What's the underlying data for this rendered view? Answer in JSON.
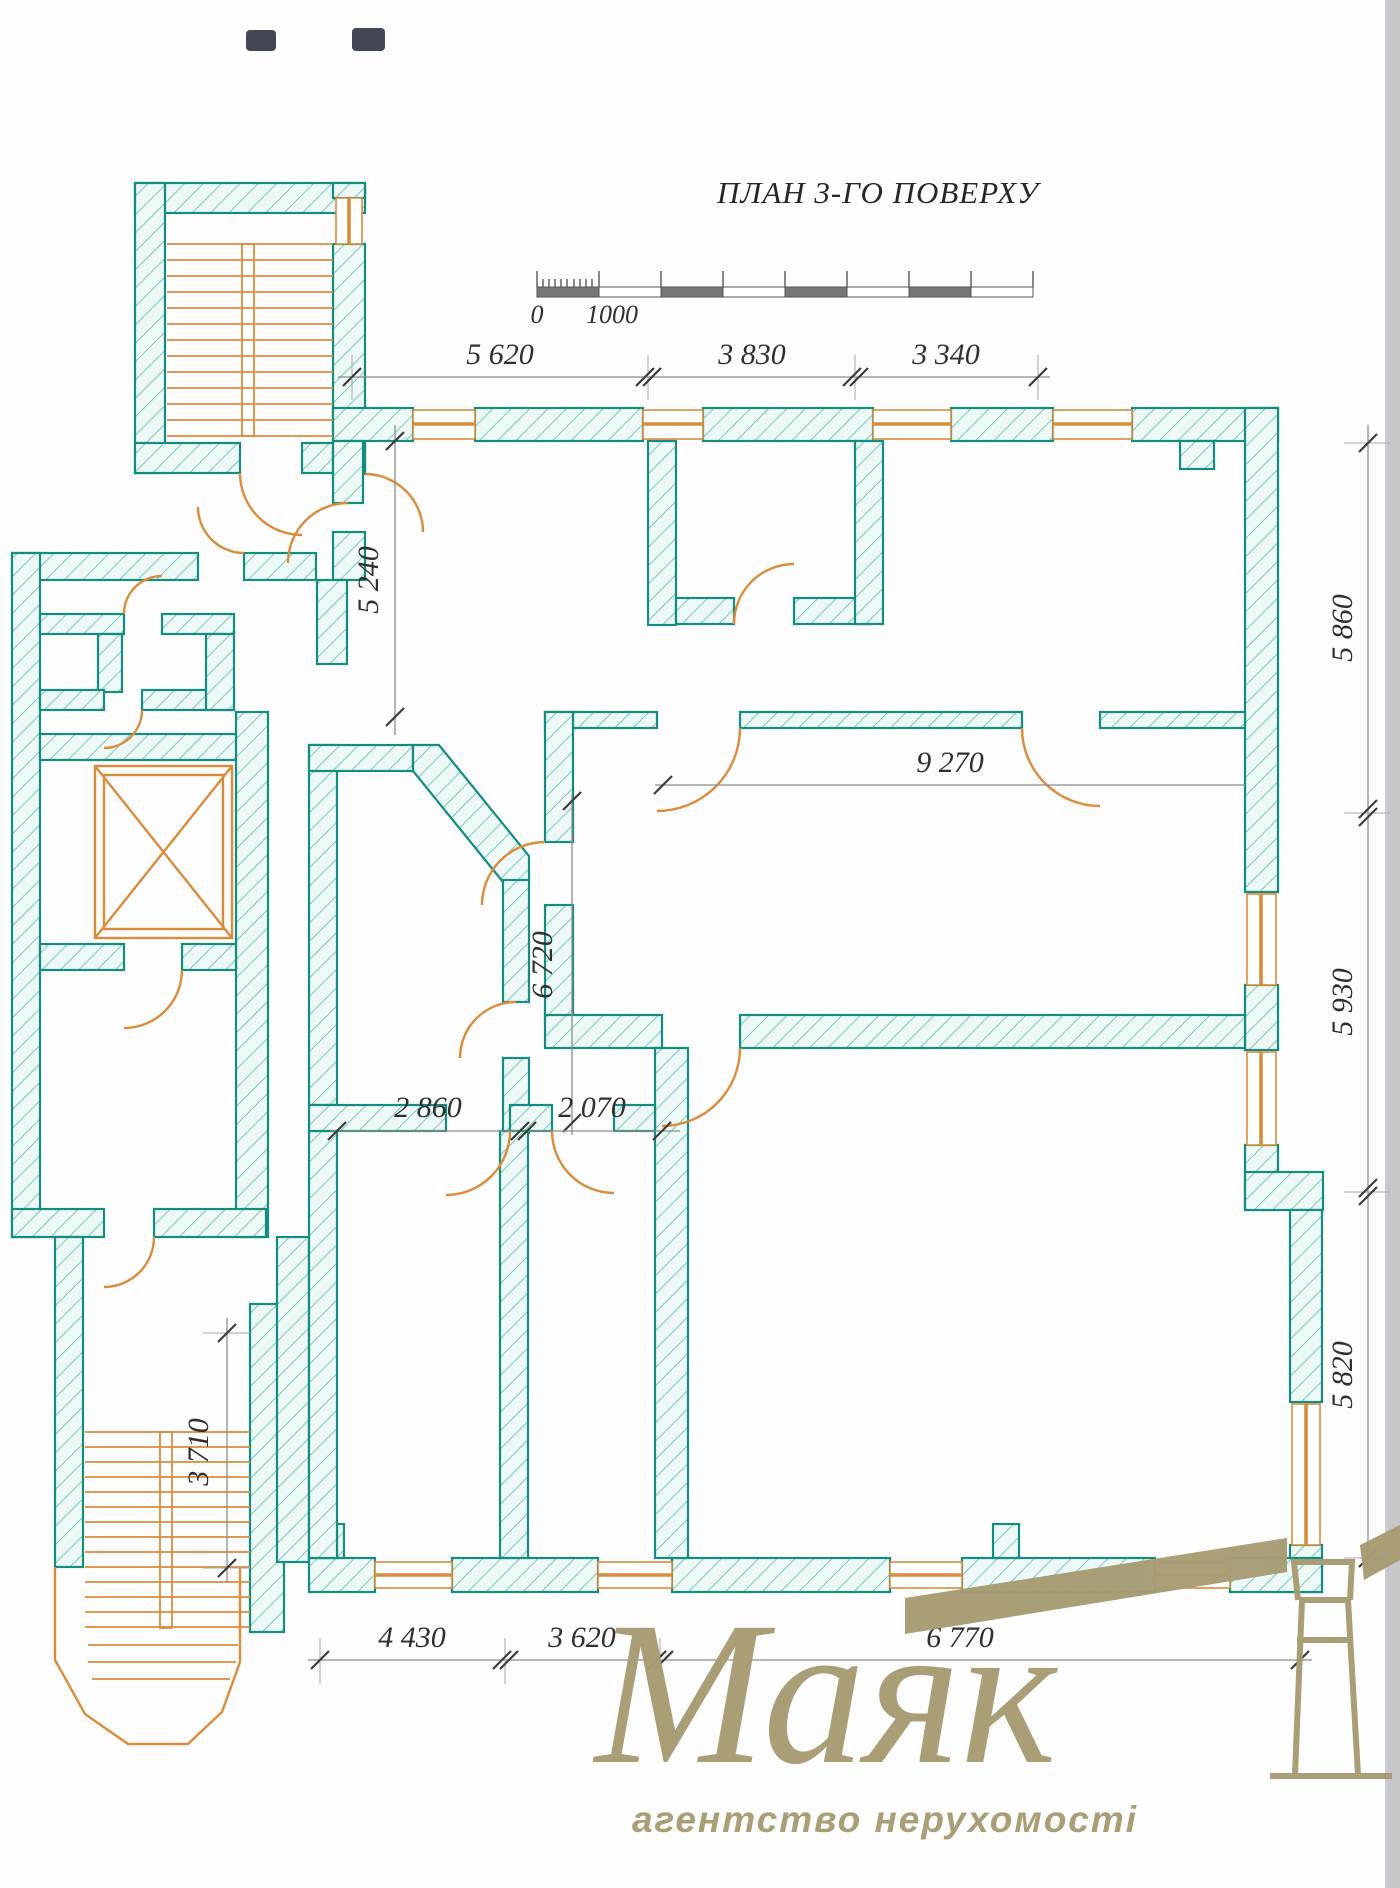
{
  "title": "ПЛАН 3-ГО ПОВЕРХУ",
  "scale_bar": {
    "start_label": "0",
    "unit_label": "1000"
  },
  "dimensions": {
    "top": [
      "5 620",
      "3 830",
      "3 340"
    ],
    "right": [
      "5 860",
      "5 930",
      "5 820"
    ],
    "bottom": [
      "4 430",
      "3 620",
      "6 770"
    ],
    "interior": {
      "upper_left_vertical": "5 240",
      "corridor_horizontal": "9 270",
      "middle_vertical": "6 720",
      "room_left_width": "2 860",
      "room_right_width": "2 070",
      "stairwell_vertical": "3 710"
    }
  },
  "watermark": {
    "brand": "Маяк",
    "tagline": "агентство нерухомості"
  },
  "colors": {
    "wall_stroke": "#148d80",
    "wall_fill": "#ecf9f6",
    "hatch_line": "#63b9ac",
    "joinery_orange": "#d98c3c",
    "dimension_text": "#2f2f2f",
    "dimension_line": "#8d8d8d",
    "watermark_olive": "#a79b72",
    "page_edge": "#c7c7cb"
  }
}
